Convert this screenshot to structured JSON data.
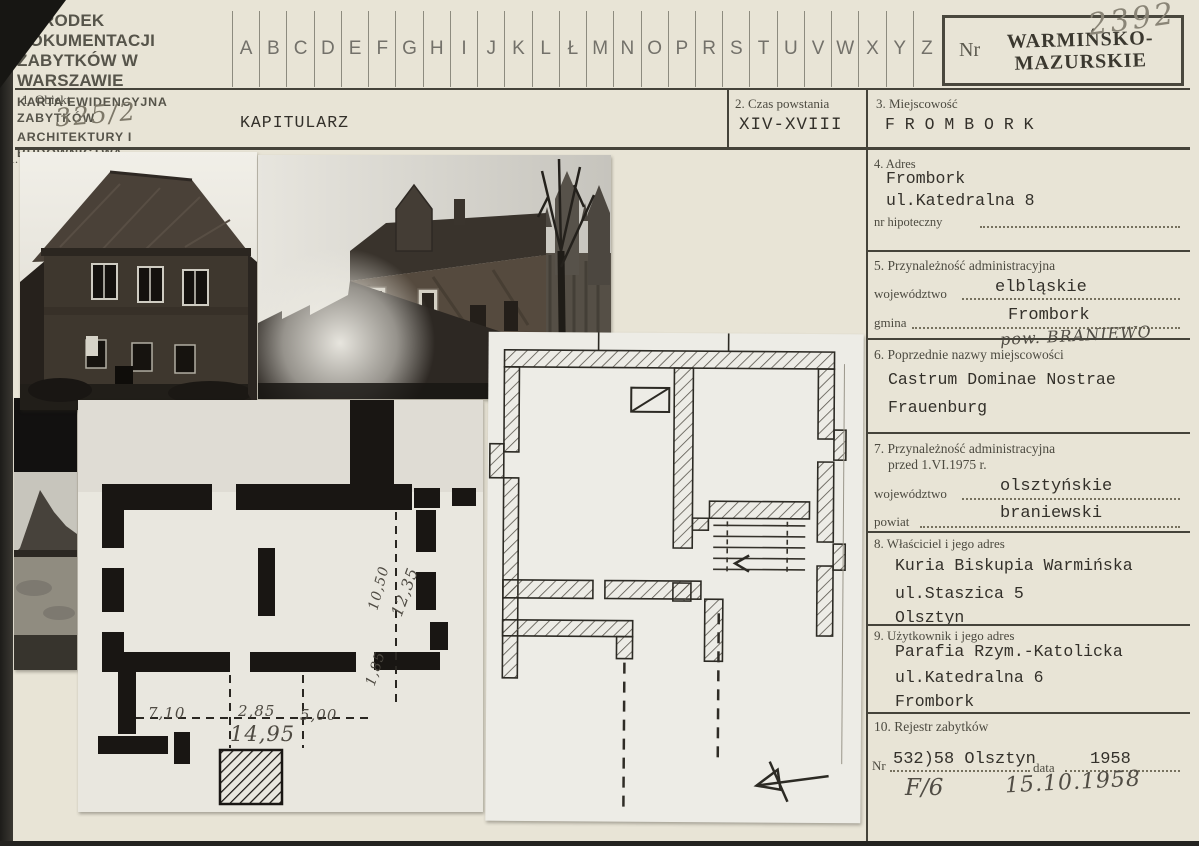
{
  "colors": {
    "card_background": "#e8e4d6",
    "scan_edge": "#2e2c28",
    "typewriter_ink": "#33302a",
    "pencil": "#7d7869",
    "pen": "#514d45",
    "stamp_ink": "#3b382f"
  },
  "header": {
    "org_line1": "OŚRODEK DOKUMENTACJI",
    "org_line2": "ZABYTKÓW W WARSZAWIE",
    "org_line3": "KARTA EWIDENCYJNA ZABYTKÓW",
    "org_line4": "ARCHITEKTURY I BUDOWNICTWA",
    "alphabet": [
      "A",
      "B",
      "C",
      "D",
      "E",
      "F",
      "G",
      "H",
      "I",
      "J",
      "K",
      "L",
      "Ł",
      "M",
      "N",
      "O",
      "P",
      "R",
      "S",
      "T",
      "U",
      "V",
      "W",
      "X",
      "Y",
      "Z"
    ],
    "nr_label": "Nr",
    "stamp_line1": "WARMIŃSKO-",
    "stamp_line2": "MAZURSKIE",
    "card_number": "2392"
  },
  "f1": {
    "label": "1. Obiekt",
    "number_handwritten": "325/2",
    "value": "KAPITULARZ"
  },
  "f2": {
    "label": "2. Czas powstania",
    "value": "XIV-XVIII"
  },
  "f3": {
    "label": "3. Miejscowość",
    "value": "F R O M B O R K"
  },
  "photos": {
    "section_label": "1."
  },
  "f4": {
    "label": "4. Adres",
    "line1": "Frombork",
    "line2": "ul.Katedralna 8",
    "sub_label": "nr hipoteczny"
  },
  "f5": {
    "label": "5. Przynależność administracyjna",
    "wojewodztwo_label": "województwo",
    "wojewodztwo": "elbląskie",
    "gmina_label": "gmina",
    "gmina": "Frombork",
    "handwritten": "pow. BRANIEWO"
  },
  "f6": {
    "label": "6. Poprzednie nazwy miejscowości",
    "line1": "Castrum Dominae Nostrae",
    "line2": "Frauenburg"
  },
  "f7": {
    "label_line1": "7. Przynależność administracyjna",
    "label_line2": "przed 1.VI.1975 r.",
    "wojewodztwo_label": "województwo",
    "wojewodztwo": "olsztyńskie",
    "powiat_label": "powiat",
    "powiat": "braniewski"
  },
  "f8": {
    "label": "8. Właściciel i jego adres",
    "line1": "Kuria Biskupia Warmińska",
    "line2": "ul.Staszica 5",
    "line3": "Olsztyn"
  },
  "f9": {
    "label": "9. Użytkownik i jego adres",
    "line1": "Parafia Rzym.-Katolicka",
    "line2": "ul.Katedralna 6",
    "line3": "Frombork"
  },
  "f10": {
    "label": "10. Rejestr zabytków",
    "nr_label": "Nr",
    "nr_value": "532)58 Olsztyn",
    "data_label": "data",
    "data_value": "1958",
    "hand1": "F/6",
    "hand2": "15.10.1958"
  },
  "plan": {
    "d710": "7,10",
    "d285": "2,85",
    "d500": "5,00",
    "d1495": "14,95",
    "d185": "1,85",
    "d1050": "10,50",
    "d1235": "12,35"
  }
}
